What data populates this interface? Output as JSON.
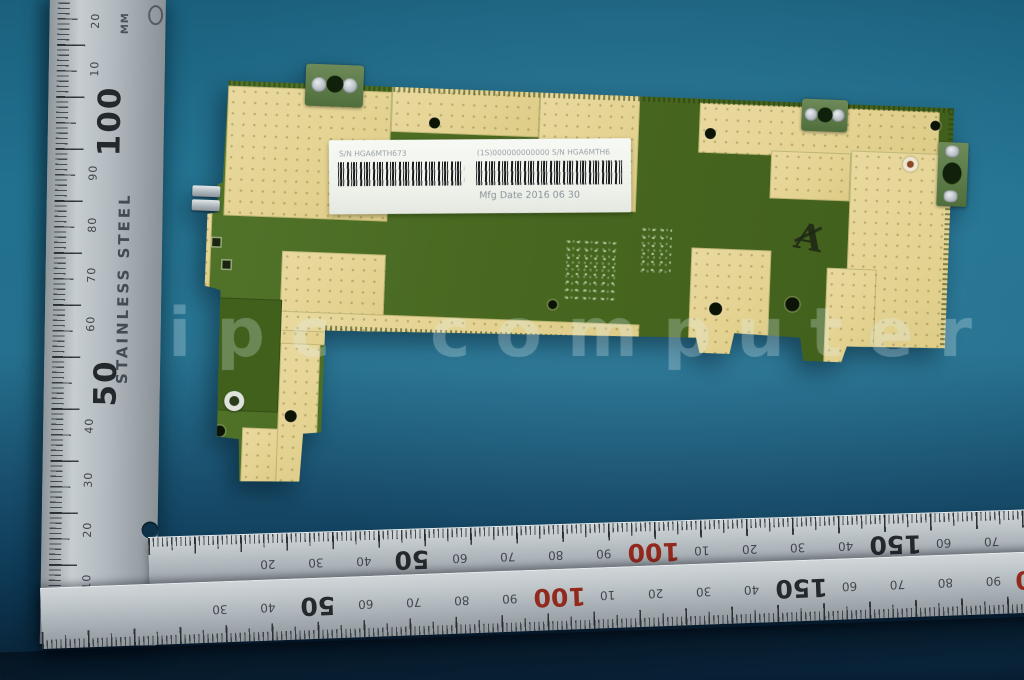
{
  "watermark": {
    "text": "ipc computer"
  },
  "pcb": {
    "label": {
      "sn_left": "S/N HGA6MTH673",
      "sn_right": "(1S)000000000000  S/N HGA6MTH6",
      "mfg": "Mfg Date 2016 06 30"
    },
    "handwriting": "A"
  },
  "vertical_ruler": {
    "material_text": "STAINLESS STEEL",
    "unit_text": "MM",
    "labels": [
      {
        "t": "20",
        "y": 28
      },
      {
        "t": "10",
        "y": 76
      },
      {
        "t": "100",
        "y": 128,
        "big": true
      },
      {
        "t": "90",
        "y": 180
      },
      {
        "t": "80",
        "y": 232
      },
      {
        "t": "70",
        "y": 282
      },
      {
        "t": "60",
        "y": 331
      },
      {
        "t": "50",
        "y": 390,
        "big": true
      },
      {
        "t": "40",
        "y": 433
      },
      {
        "t": "30",
        "y": 487
      },
      {
        "t": "20",
        "y": 537
      },
      {
        "t": "10",
        "y": 589
      }
    ]
  },
  "ruler_upper": {
    "labels": [
      {
        "t": "20",
        "x": 119
      },
      {
        "t": "30",
        "x": 167
      },
      {
        "t": "40",
        "x": 215
      },
      {
        "t": "50",
        "x": 263,
        "big": true
      },
      {
        "t": "60",
        "x": 311
      },
      {
        "t": "70",
        "x": 359
      },
      {
        "t": "80",
        "x": 407
      },
      {
        "t": "90",
        "x": 455
      },
      {
        "t": "100",
        "x": 505,
        "big": true,
        "red": true
      },
      {
        "t": "10",
        "x": 553
      },
      {
        "t": "20",
        "x": 601
      },
      {
        "t": "30",
        "x": 649
      },
      {
        "t": "40",
        "x": 697
      },
      {
        "t": "150",
        "x": 747,
        "big": true
      },
      {
        "t": "60",
        "x": 795
      },
      {
        "t": "70",
        "x": 843
      },
      {
        "t": "80",
        "x": 891
      },
      {
        "t": "90",
        "x": 939
      }
    ]
  },
  "ruler_lower": {
    "labels": [
      {
        "t": "30",
        "x": 179
      },
      {
        "t": "40",
        "x": 227
      },
      {
        "t": "50",
        "x": 277,
        "big": true
      },
      {
        "t": "60",
        "x": 325
      },
      {
        "t": "70",
        "x": 373
      },
      {
        "t": "80",
        "x": 421
      },
      {
        "t": "90",
        "x": 469
      },
      {
        "t": "100",
        "x": 519,
        "big": true,
        "red": true
      },
      {
        "t": "10",
        "x": 567
      },
      {
        "t": "20",
        "x": 615
      },
      {
        "t": "30",
        "x": 663
      },
      {
        "t": "40",
        "x": 711
      },
      {
        "t": "150",
        "x": 761,
        "big": true
      },
      {
        "t": "60",
        "x": 809
      },
      {
        "t": "70",
        "x": 857
      },
      {
        "t": "80",
        "x": 905
      },
      {
        "t": "90",
        "x": 953
      },
      {
        "t": "200",
        "x": 1001,
        "big": true,
        "red": true
      }
    ]
  },
  "colors": {
    "background_teal": "#21718f",
    "ruler_metal": "#b7bfc4",
    "pcb_green": "#47661f",
    "pcb_beige": "#e4d392",
    "label_white": "#f3f5ef",
    "ruler_red_number": "#92291c"
  }
}
